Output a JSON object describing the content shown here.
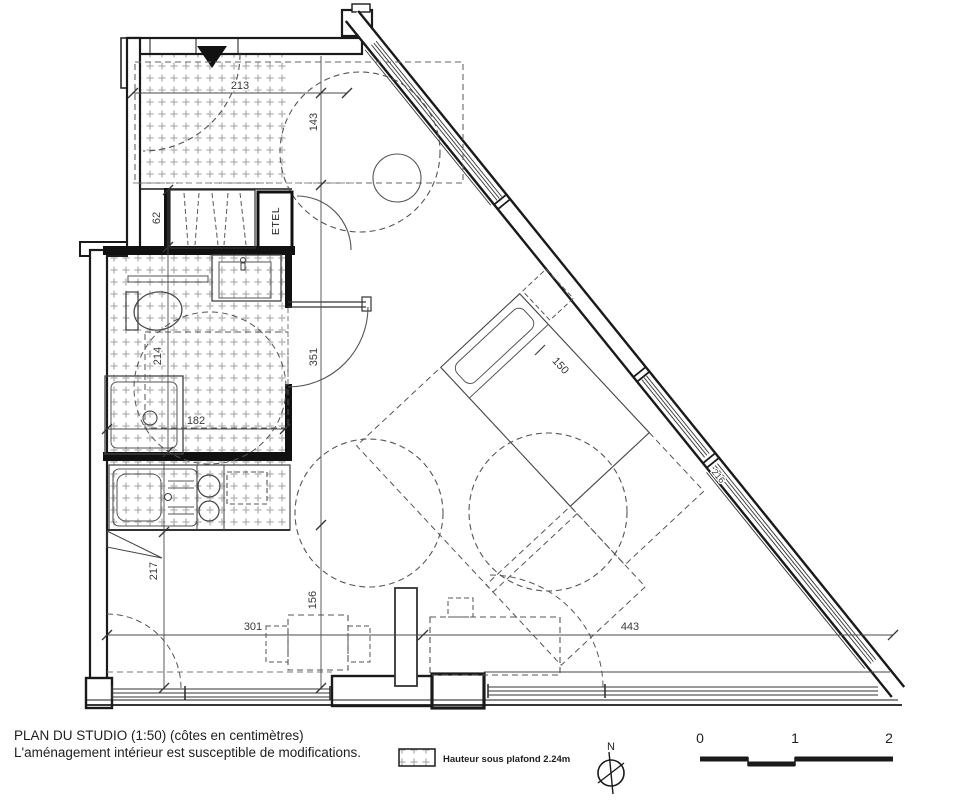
{
  "plan": {
    "dims": {
      "d213": "213",
      "d143": "143",
      "d62": "62",
      "d214": "214",
      "d182": "182",
      "d351": "351",
      "d217": "217",
      "d156": "156",
      "d301": "301",
      "d443": "443",
      "d150": "150",
      "d216": "216"
    },
    "labels": {
      "etel": "ETEL"
    }
  },
  "footer": {
    "title_line1": "PLAN DU STUDIO (1:50) (côtes en centimètres)",
    "title_line2": "L'aménagement intérieur est susceptible de modifications.",
    "legend_text": "Hauteur sous plafond 2.24m",
    "north_label": "N",
    "scale_ticks": {
      "t0": "0",
      "t1": "1",
      "t2": "2"
    }
  },
  "colors": {
    "line": "#1a1a1a",
    "hatch": "#bcbcbc",
    "dim": "#3a3a3a"
  }
}
